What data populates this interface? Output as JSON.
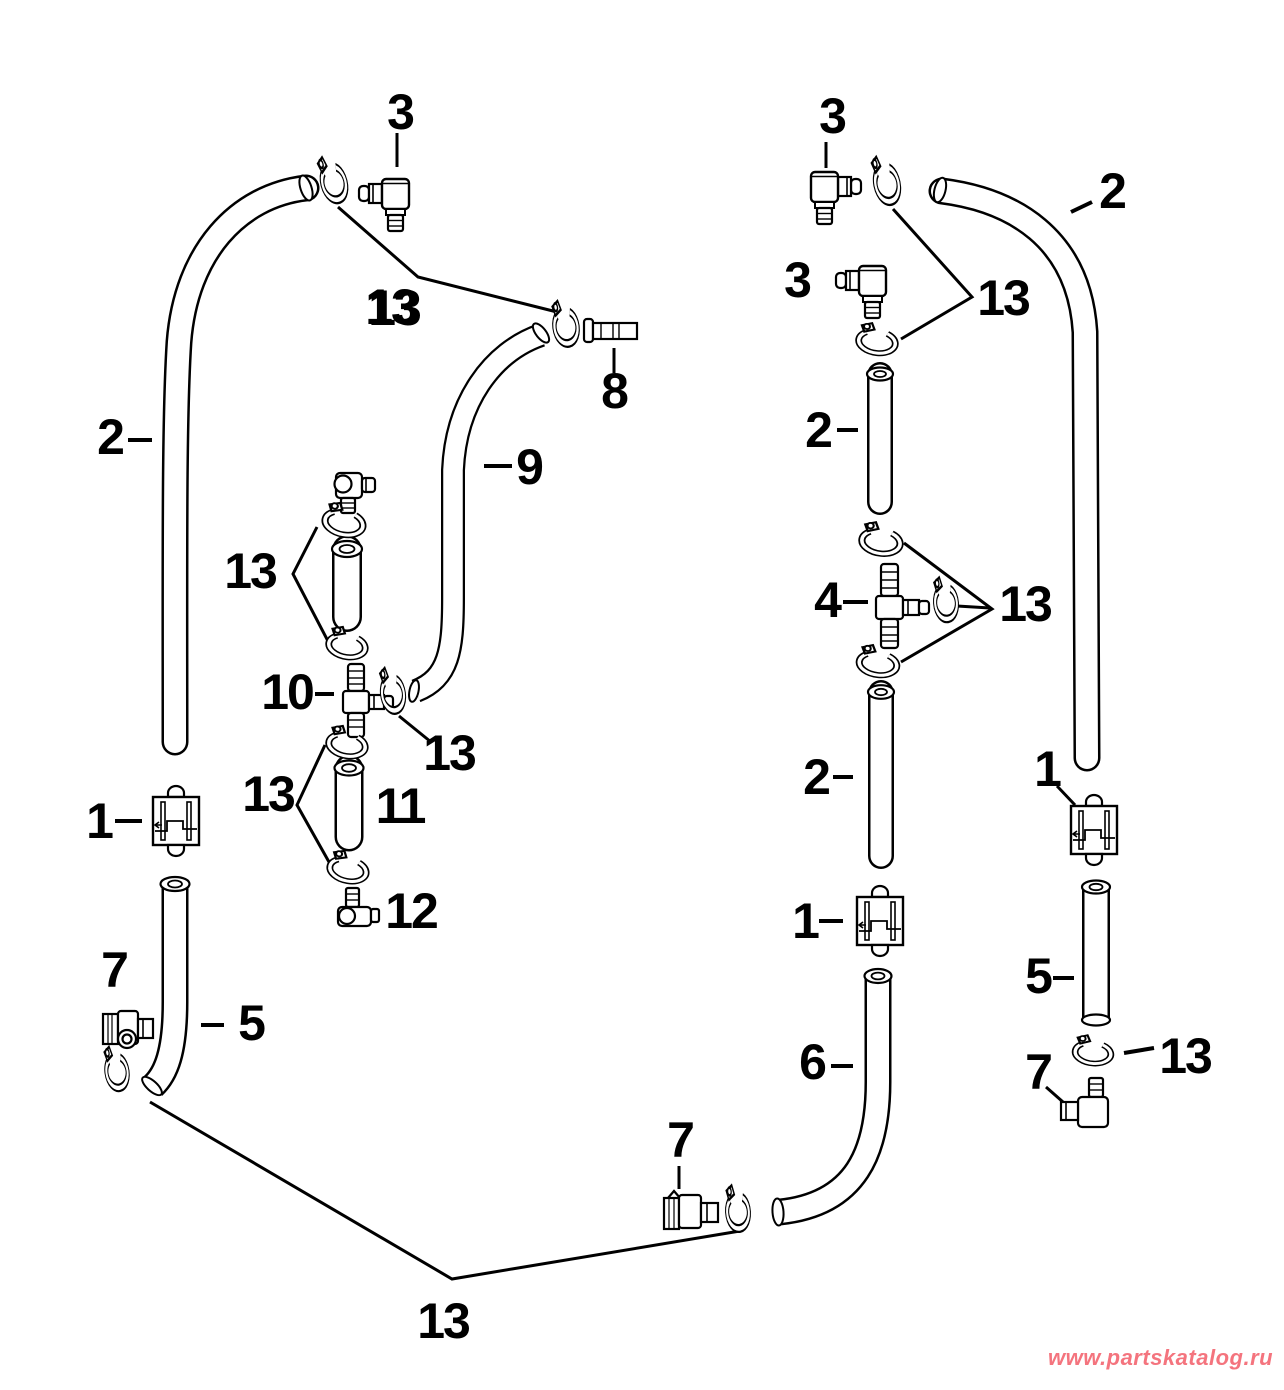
{
  "diagram": {
    "watermark": "www.partskatalog.ru",
    "watermark_color": "#f4747e",
    "line_color": "#000000",
    "background_color": "#ffffff",
    "callouts": [
      {
        "label": "3"
      },
      {
        "label": "13"
      },
      {
        "label": "8"
      },
      {
        "label": "2"
      },
      {
        "label": "9"
      },
      {
        "label": "13"
      },
      {
        "label": "10"
      },
      {
        "label": "13"
      },
      {
        "label": "13"
      },
      {
        "label": "1"
      },
      {
        "label": "11"
      },
      {
        "label": "12"
      },
      {
        "label": "7"
      },
      {
        "label": "5"
      },
      {
        "label": "13"
      },
      {
        "label": "7"
      },
      {
        "label": "3"
      },
      {
        "label": "2"
      },
      {
        "label": "3"
      },
      {
        "label": "13"
      },
      {
        "label": "2"
      },
      {
        "label": "4"
      },
      {
        "label": "13"
      },
      {
        "label": "2"
      },
      {
        "label": "1"
      },
      {
        "label": "1"
      },
      {
        "label": "5"
      },
      {
        "label": "6"
      },
      {
        "label": "13"
      },
      {
        "label": "7"
      }
    ]
  }
}
